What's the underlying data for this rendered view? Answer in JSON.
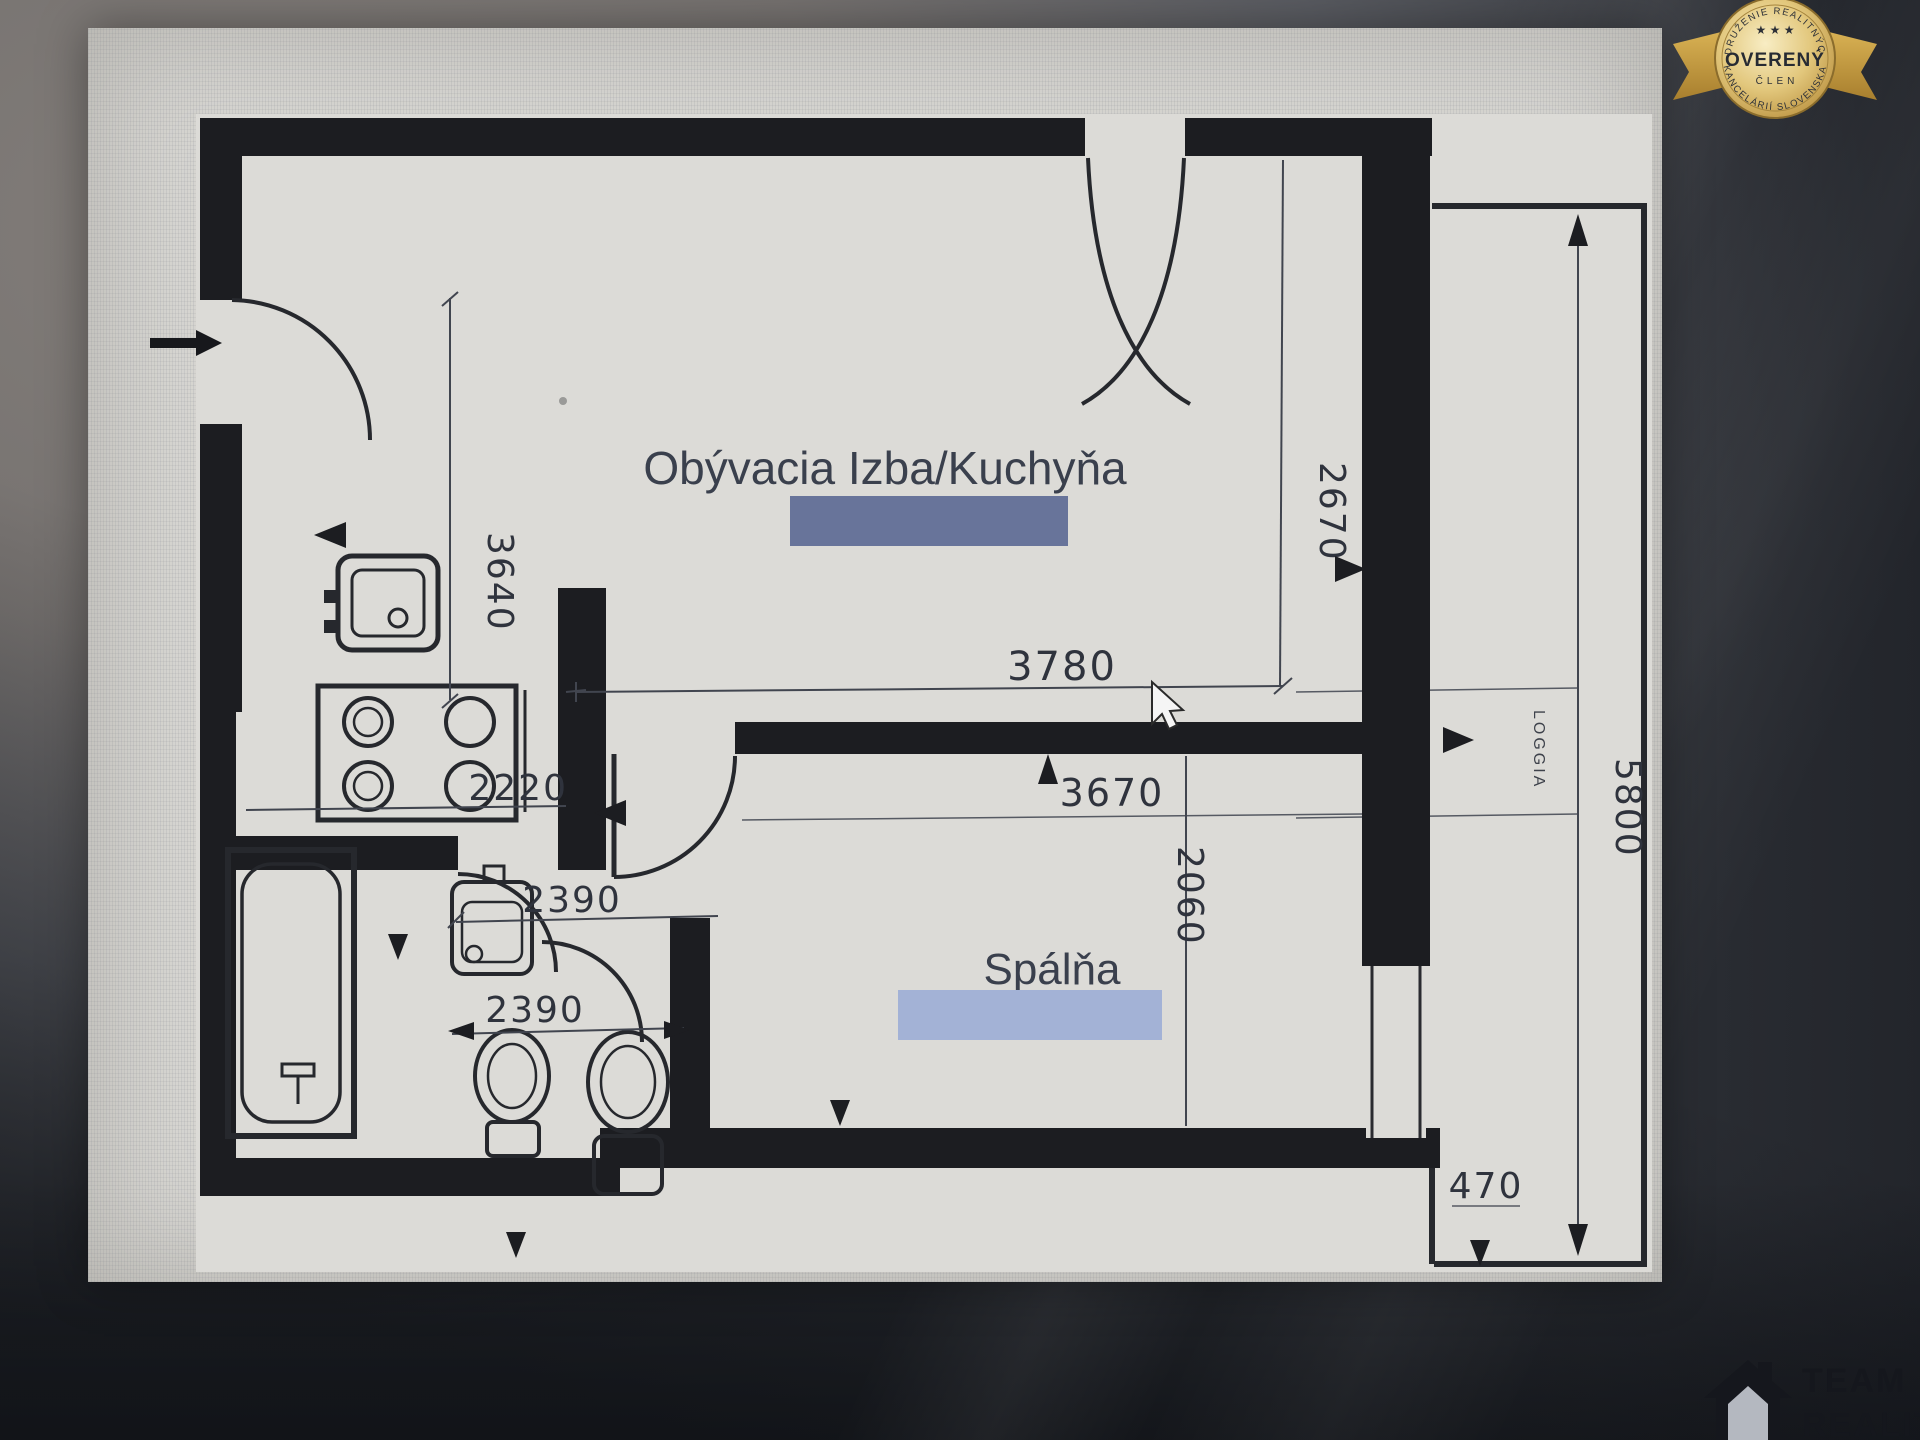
{
  "badge": {
    "arc_top": "ZDRUŽENIE REALITNÝCH",
    "stars": "★ ★ ★",
    "title": "OVERENÝ",
    "subtitle": "ČLEN",
    "arc_bottom": "KANCELÁRIÍ SLOVENSKA"
  },
  "logo": {
    "line1": "TEAM",
    "line2": "REALITY"
  },
  "floor_plan": {
    "rooms": {
      "living": "Obývacia Izba/Kuchyňa",
      "bedroom": "Spálňa",
      "loggia": "LOGGIA"
    },
    "dimensions": {
      "entry_depth": "3640",
      "living_right": "2670",
      "living_width": "3780",
      "kitchen_width": "2220",
      "bedroom_width": "3670",
      "hall_a": "2390",
      "hall_b": "2390",
      "bedroom_depth": "2060",
      "loggia_length": "5800",
      "loggia_width": "470"
    }
  },
  "colors": {
    "living_highlight": "#68749a",
    "bedroom_highlight": "#a3b2d6",
    "badge_gold": "#d9b254"
  }
}
